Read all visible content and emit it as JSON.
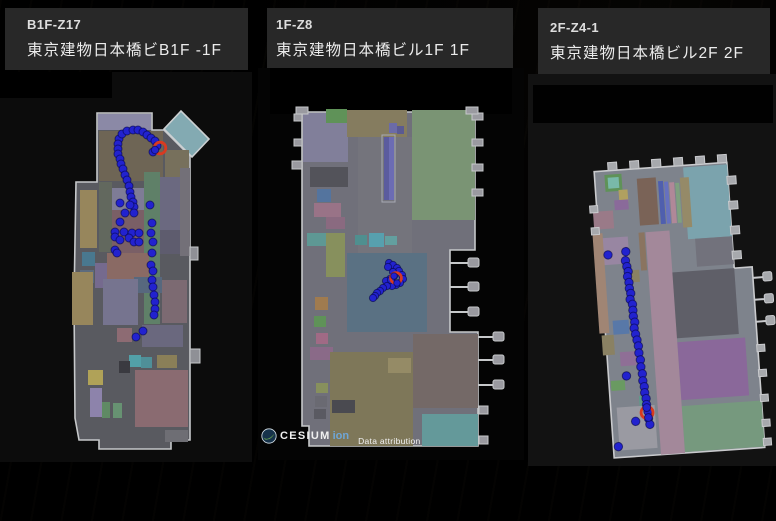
{
  "app": {
    "background": "#000000",
    "header_bg": "#282828"
  },
  "panels": [
    {
      "zone_id": "B1F-Z17",
      "title": "東京建物日本橋ビB1F -1F",
      "trajectory": {
        "radius": 4,
        "dot_color": "#2222cf",
        "highlight_color": "#d93a20",
        "points": [
          [
            119,
            139
          ],
          [
            122,
            134
          ],
          [
            127,
            131
          ],
          [
            133,
            130
          ],
          [
            138,
            130
          ],
          [
            143,
            132
          ],
          [
            147,
            135
          ],
          [
            151,
            138
          ],
          [
            155,
            141
          ],
          [
            157,
            146
          ],
          [
            153,
            152
          ],
          [
            118,
            144
          ],
          [
            118,
            149
          ],
          [
            118,
            154
          ],
          [
            120,
            159
          ],
          [
            121,
            164
          ],
          [
            123,
            169
          ],
          [
            125,
            175
          ],
          [
            127,
            180
          ],
          [
            129,
            186
          ],
          [
            130,
            192
          ],
          [
            131,
            197
          ],
          [
            133,
            202
          ],
          [
            134,
            207
          ],
          [
            120,
            203
          ],
          [
            130,
            205
          ],
          [
            125,
            213
          ],
          [
            134,
            213
          ],
          [
            120,
            222
          ],
          [
            115,
            232
          ],
          [
            124,
            232
          ],
          [
            132,
            233
          ],
          [
            139,
            233
          ],
          [
            115,
            237
          ],
          [
            120,
            240
          ],
          [
            129,
            238
          ],
          [
            134,
            242
          ],
          [
            139,
            242
          ],
          [
            115,
            250
          ],
          [
            117,
            253
          ],
          [
            150,
            205
          ],
          [
            152,
            223
          ],
          [
            151,
            233
          ],
          [
            153,
            242
          ],
          [
            152,
            253
          ],
          [
            151,
            265
          ],
          [
            153,
            271
          ],
          [
            152,
            280
          ],
          [
            153,
            287
          ],
          [
            154,
            295
          ],
          [
            155,
            302
          ],
          [
            155,
            309
          ],
          [
            154,
            315
          ],
          [
            143,
            331
          ],
          [
            136,
            337
          ]
        ],
        "highlights": [
          [
            160,
            148
          ]
        ],
        "points_over": [
          [
            155,
            150
          ]
        ]
      }
    },
    {
      "zone_id": "1F-Z8",
      "title": "東京建物日本橋ビル1F 1F",
      "trajectory": {
        "radius": 3.6,
        "dot_color": "#2222cf",
        "highlight_color": "#d93a20",
        "points": [
          [
            389,
            263
          ],
          [
            393,
            265
          ],
          [
            388,
            267
          ],
          [
            397,
            268
          ],
          [
            399,
            271
          ],
          [
            393,
            272
          ],
          [
            402,
            275
          ],
          [
            394,
            276
          ],
          [
            403,
            279
          ],
          [
            390,
            279
          ],
          [
            386,
            281
          ],
          [
            400,
            283
          ],
          [
            396,
            285
          ],
          [
            392,
            286
          ],
          [
            387,
            286
          ],
          [
            391,
            280
          ],
          [
            383,
            288
          ],
          [
            380,
            291
          ],
          [
            377,
            293
          ],
          [
            375,
            296
          ],
          [
            373,
            298
          ]
        ],
        "highlights": [
          [
            396,
            278
          ]
        ],
        "points_over": [
          [
            394,
            276
          ],
          [
            397,
            283
          ]
        ]
      }
    },
    {
      "zone_id": "2F-Z4-1",
      "title": "東京建物日本橋ビル2F 2F",
      "trajectory": {
        "radius": 4.2,
        "dot_color": "#2222cf",
        "highlight_color": "#d93a20",
        "points": [
          [
            612,
            250
          ],
          [
            630,
            248
          ],
          [
            629,
            257
          ],
          [
            630,
            263
          ],
          [
            631,
            268
          ],
          [
            630,
            273
          ],
          [
            631,
            279
          ],
          [
            631,
            285
          ],
          [
            632,
            290
          ],
          [
            631,
            296
          ],
          [
            633,
            301
          ],
          [
            633,
            307
          ],
          [
            633,
            313
          ],
          [
            634,
            319
          ],
          [
            633,
            325
          ],
          [
            634,
            331
          ],
          [
            635,
            337
          ],
          [
            636,
            343
          ],
          [
            636,
            350
          ],
          [
            637,
            357
          ],
          [
            637,
            364
          ],
          [
            638,
            371
          ],
          [
            638,
            378
          ],
          [
            639,
            384
          ],
          [
            639,
            390
          ],
          [
            640,
            396
          ],
          [
            640,
            402
          ],
          [
            641,
            409
          ],
          [
            641,
            416
          ],
          [
            642,
            422
          ],
          [
            622,
            372
          ],
          [
            628,
            418
          ],
          [
            609,
            442
          ]
        ],
        "highlights": [
          [
            640,
            410
          ]
        ],
        "points_over": [
          [
            640,
            405
          ],
          [
            641,
            415
          ]
        ]
      }
    }
  ],
  "attribution": {
    "brand": "CESIUM",
    "brand_suffix": "ion",
    "label": "Data attribution",
    "brand_suffix_color": "#6fa6d6"
  }
}
